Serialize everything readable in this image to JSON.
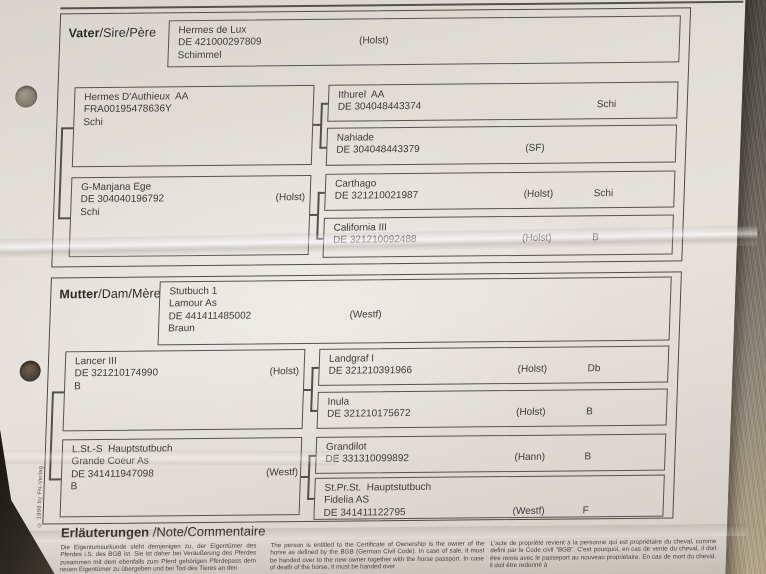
{
  "document": {
    "copyright": "© 1998 by FN-Verlag",
    "sire_section": {
      "label_main": "Vater",
      "label_sub": "/Sire/Père",
      "sire": {
        "name": "Hermes de Lux",
        "id": "DE 421000297809",
        "studbook": "(Holst)",
        "color": "Schimmel"
      },
      "sire_sire": {
        "name": "Hermes D'Authieux  AA",
        "id": "FRA00195478636Y",
        "studbook": "",
        "color": "Schi"
      },
      "sire_dam": {
        "name": "G-Manjana Ege",
        "id": "DE 304040196792",
        "studbook": "(Holst)",
        "color": "Schi"
      },
      "sire_sire_sire": {
        "name": "Ithurel  AA",
        "id": "DE 304048443374",
        "studbook": "",
        "color": "Schi"
      },
      "sire_sire_dam": {
        "name": "Nahiade",
        "id": "DE 304048443379",
        "studbook": "(SF)",
        "color": ""
      },
      "sire_dam_sire": {
        "name": "Carthago",
        "id": "DE 321210021987",
        "studbook": "(Holst)",
        "color": "Schi"
      },
      "sire_dam_dam": {
        "name": "California III",
        "id": "DE 321210092488",
        "studbook": "(Holst)",
        "color": "B"
      }
    },
    "dam_section": {
      "label_main": "Mutter",
      "label_sub": "/Dam/Mère",
      "dam": {
        "title": "Stutbuch 1",
        "name": "Lamour As",
        "id": "DE 441411485002",
        "studbook": "(Westf)",
        "color": "Braun"
      },
      "dam_sire": {
        "name": "Lancer III",
        "id": "DE 321210174990",
        "studbook": "(Holst)",
        "color": "B"
      },
      "dam_dam": {
        "title": "L.St.-S  Hauptstutbuch",
        "name": "Grande Coeur As",
        "id": "DE 341411947098",
        "studbook": "(Westf)",
        "color": "B"
      },
      "dam_sire_sire": {
        "name": "Landgraf I",
        "id": "DE 321210391966",
        "studbook": "(Holst)",
        "color": "Db"
      },
      "dam_sire_dam": {
        "name": "Inula",
        "id": "DE 321210175672",
        "studbook": "(Holst)",
        "color": "B"
      },
      "dam_dam_sire": {
        "name": "Grandilot",
        "id": "DE 331310099892",
        "studbook": "(Hann)",
        "color": "B"
      },
      "dam_dam_dam": {
        "title": "St.Pr.St.  Hauptstutbuch",
        "name": "Fidelia AS",
        "id": "DE 341411122795",
        "studbook": "(Westf)",
        "color": "F"
      }
    },
    "notes": {
      "heading_main": "Erläuterungen",
      "heading_sub": " /Note/Commentaire",
      "german": "Die Eigentumsurkunde steht demjenigen zu, der Eigentümer des Pferdes i.S. des BGB ist. Sie ist daher bei Veräußerung des Pferdes zusammen mit dem ebenfalls zum Pferd gehörigen Pferdepass dem neuen Eigentümer zu übergeben und bei Tod des Tieres an den",
      "english": "The person is entitled to the Certificate of Ownership is the owner of the horse as defined by the BGB (German Civil Code). In case of sale, it must be handed over to the new owner together with the horse passport. In case of death of the horse, it must be handed over",
      "french": "L'acte de propriété revient à la personne qui est propriétaire du cheval, comme defini par le Code civil \"BGB\". C'est pourquoi, en cas de vente du cheval, il doit être remis avec le passeport au nouveau propriétaire. En cas de mort du cheval, il doit être redonné à"
    }
  }
}
